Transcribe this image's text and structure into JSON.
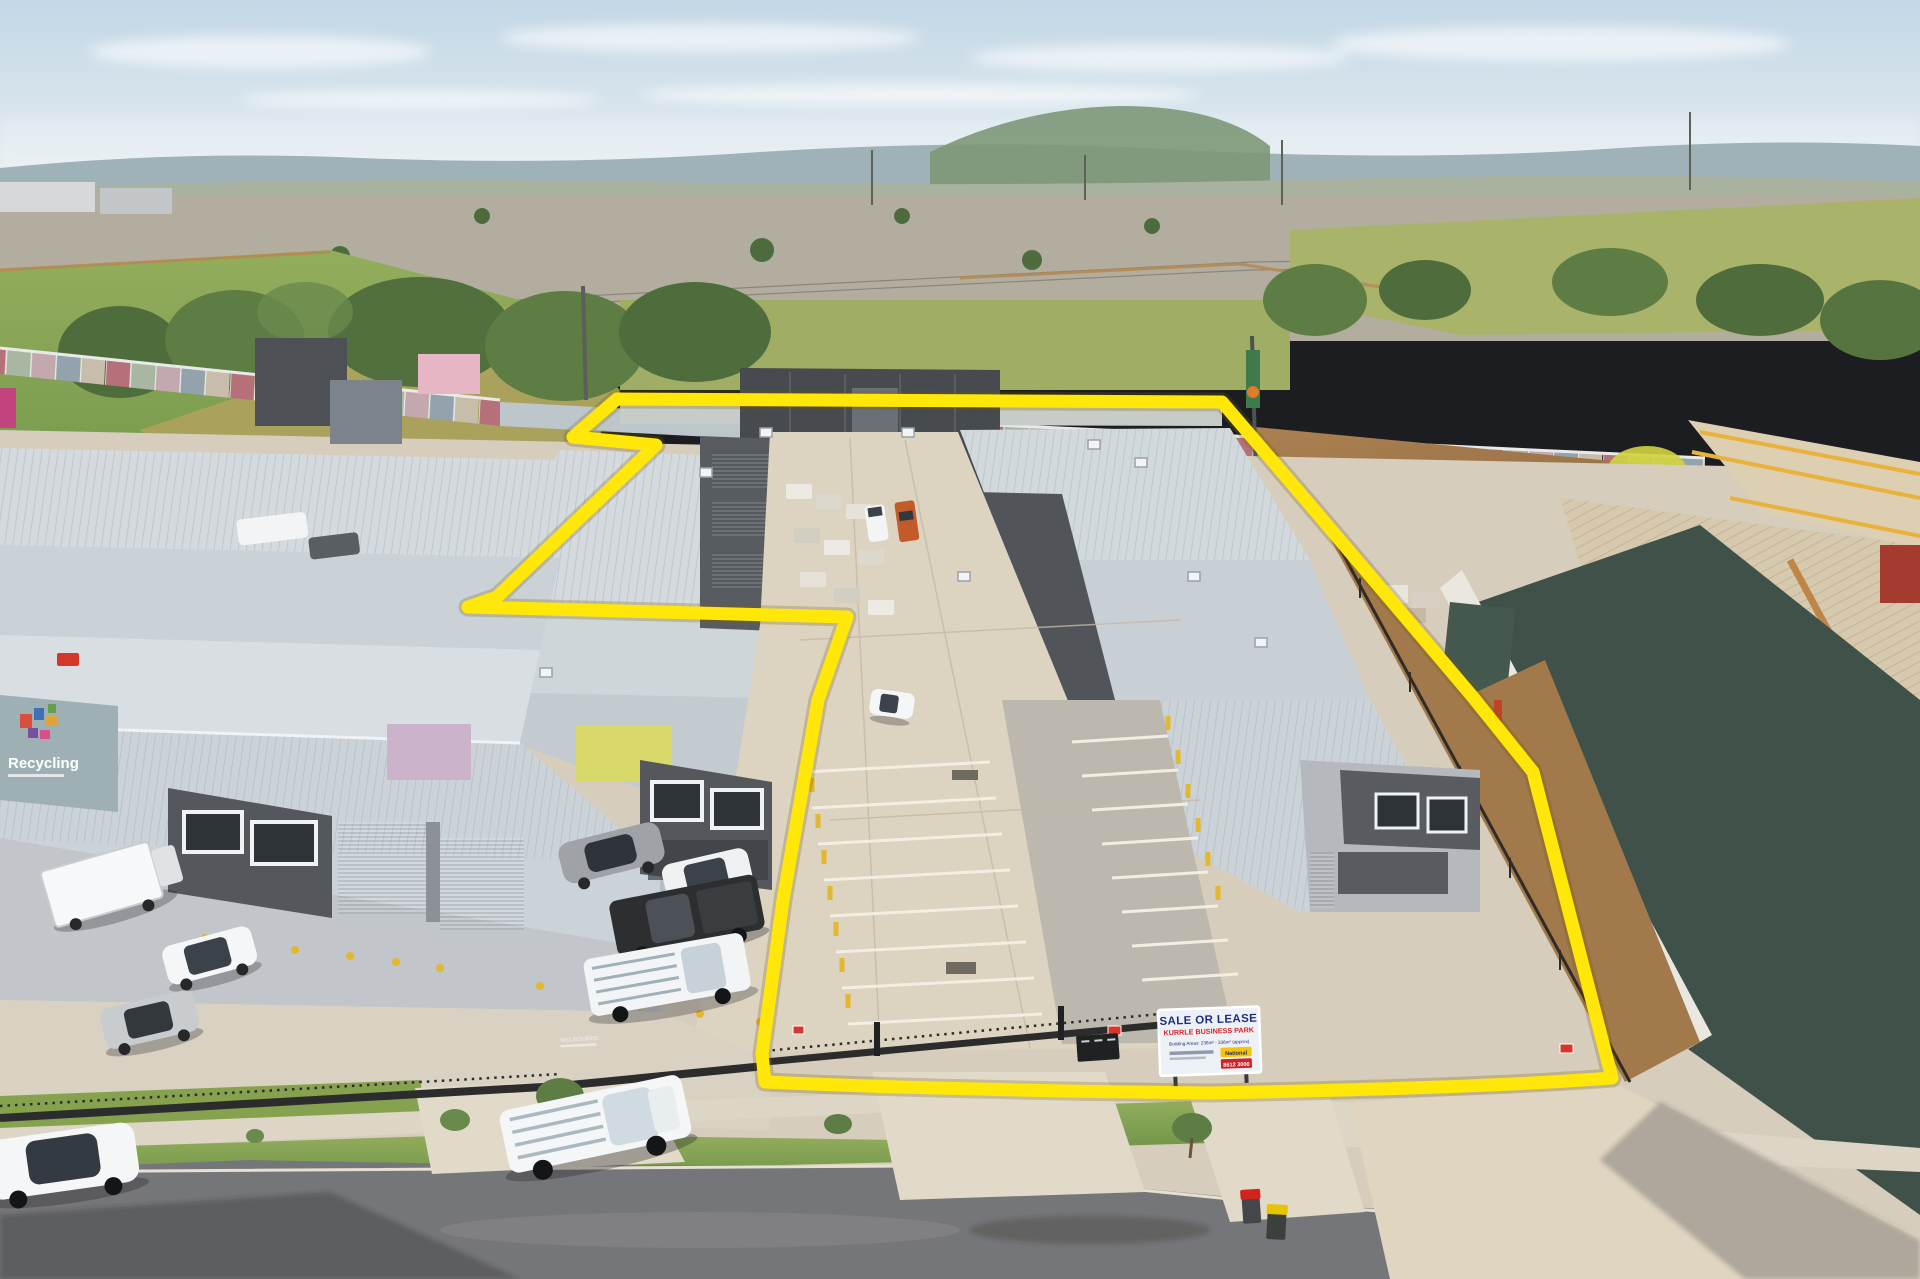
{
  "sign": {
    "title": "SALE OR LEASE",
    "subtitle": "KURRLE BUSINESS PARK",
    "detail": "Building Areas: 236m² - 336m² (approx)",
    "brand": "National",
    "phone": "8612 3000",
    "colors": {
      "title": "#1d2f7c",
      "subtitle": "#d6232a",
      "board": "#edf1f6",
      "brand_bg": "#f6c400",
      "brand_text": "#1d2f7c",
      "phone_bg": "#cf2127",
      "phone_text": "#ffffff"
    }
  },
  "mural": {
    "text": "Recycling",
    "color": "#ffffff"
  },
  "fence_sign": {
    "text": "MELBOURNE"
  },
  "bins": {
    "red_lid": "#d4231f",
    "yellow_lid": "#e8c400"
  },
  "colors": {
    "boundary": "#ffe70a",
    "sky_top": "#c9dbe8",
    "grass": "#7fa04b",
    "concrete": "#d6cdbc",
    "asphalt": "#75767a",
    "roof": "#ccd3d8",
    "charcoal": "#54575b",
    "teal_wall": "#3f5149"
  }
}
